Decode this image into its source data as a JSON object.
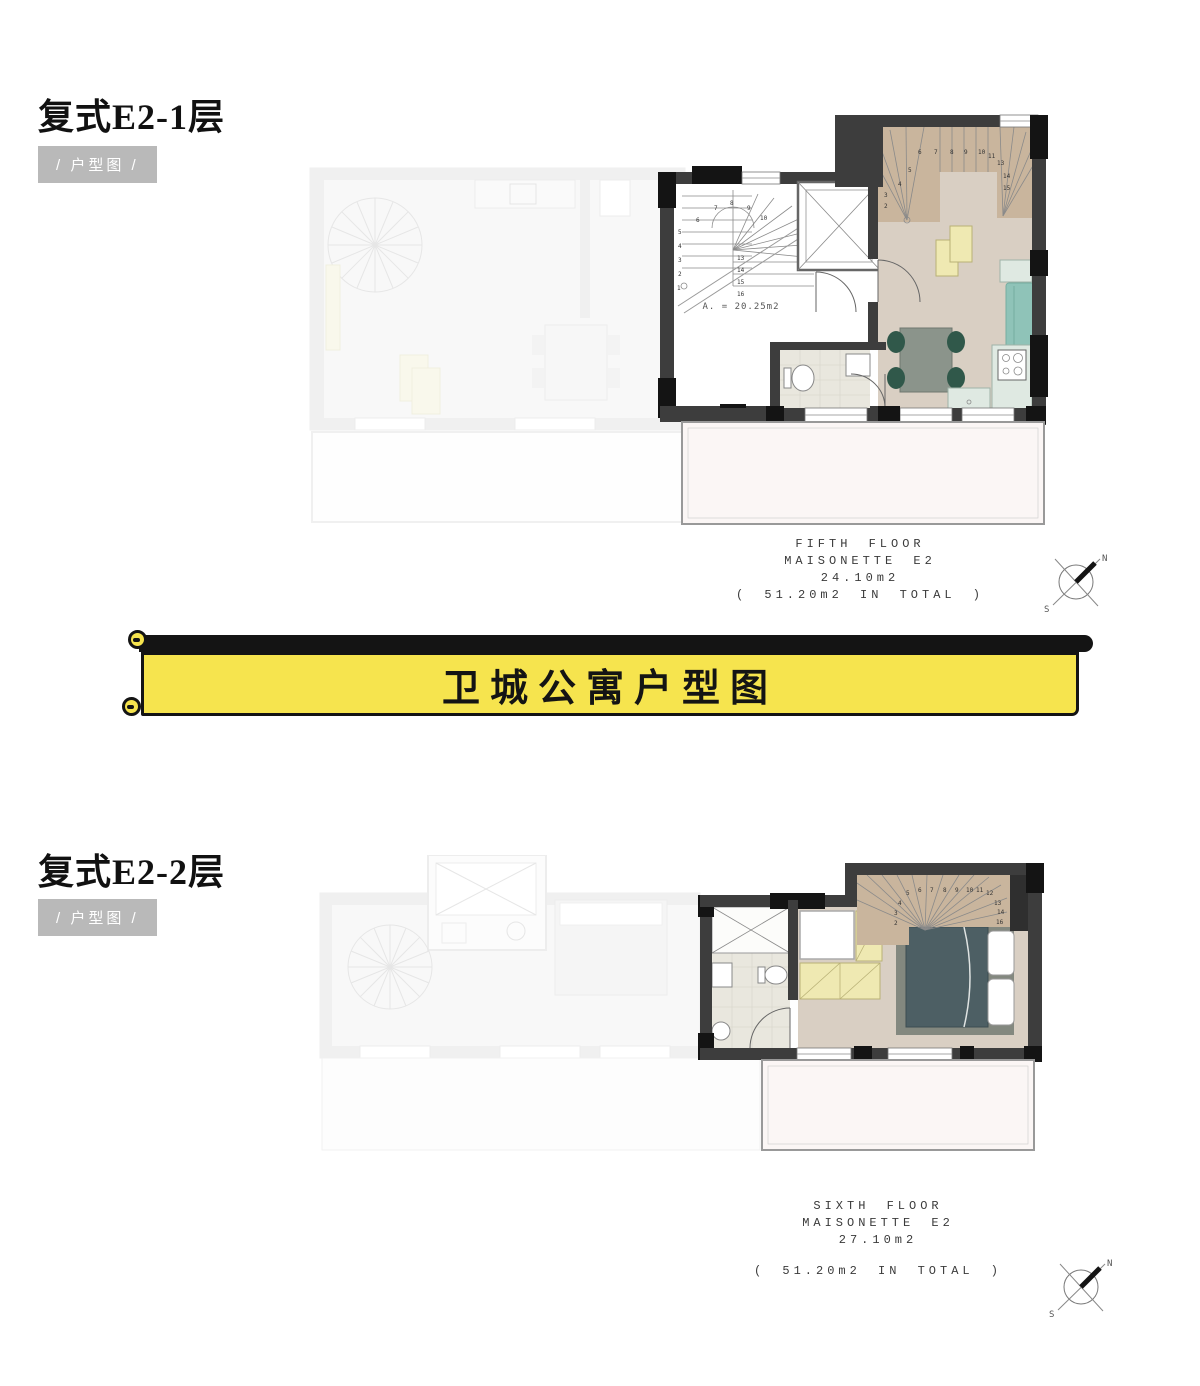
{
  "sections": {
    "s1": {
      "title": "复式E2-1层",
      "badge": "/ 户型图 /",
      "annotation": [
        "FIFTH FLOOR",
        "MAISONETTE E2",
        "24.10m2",
        "( 51.20m2 IN TOTAL )"
      ],
      "area_label": "A. = 20.25m2"
    },
    "s2": {
      "title": "复式E2-2层",
      "badge": "/ 户型图 /",
      "annotation": [
        "SIXTH FLOOR",
        "MAISONETTE E2",
        "27.10m2",
        "( 51.20m2 IN TOTAL )"
      ]
    }
  },
  "banner": {
    "title": "卫城公寓户型图"
  },
  "compass": {
    "north": "N",
    "south": "S"
  },
  "stair_numbers": [
    "1",
    "2",
    "3",
    "4",
    "5",
    "6",
    "7",
    "8",
    "9",
    "10",
    "11",
    "12",
    "13",
    "14",
    "15",
    "16"
  ],
  "colors": {
    "banner_yellow": "#f6e44e",
    "badge_gray": "#b9b9b9",
    "wall_charcoal": "#3d3d3d",
    "wall_black": "#141414",
    "wood_floor": "#d9cfc3",
    "stair_wood": "#c9b59d",
    "tile": "#e9e7de",
    "counter_mint": "#dfe9e2",
    "sofa_teal": "#8fc3b8",
    "table_yellow": "#efe9b2",
    "chair_green": "#30584a",
    "bed_slate": "#4d5f64",
    "rug_gray": "#83887f",
    "terrace": "#fbf6f5"
  }
}
